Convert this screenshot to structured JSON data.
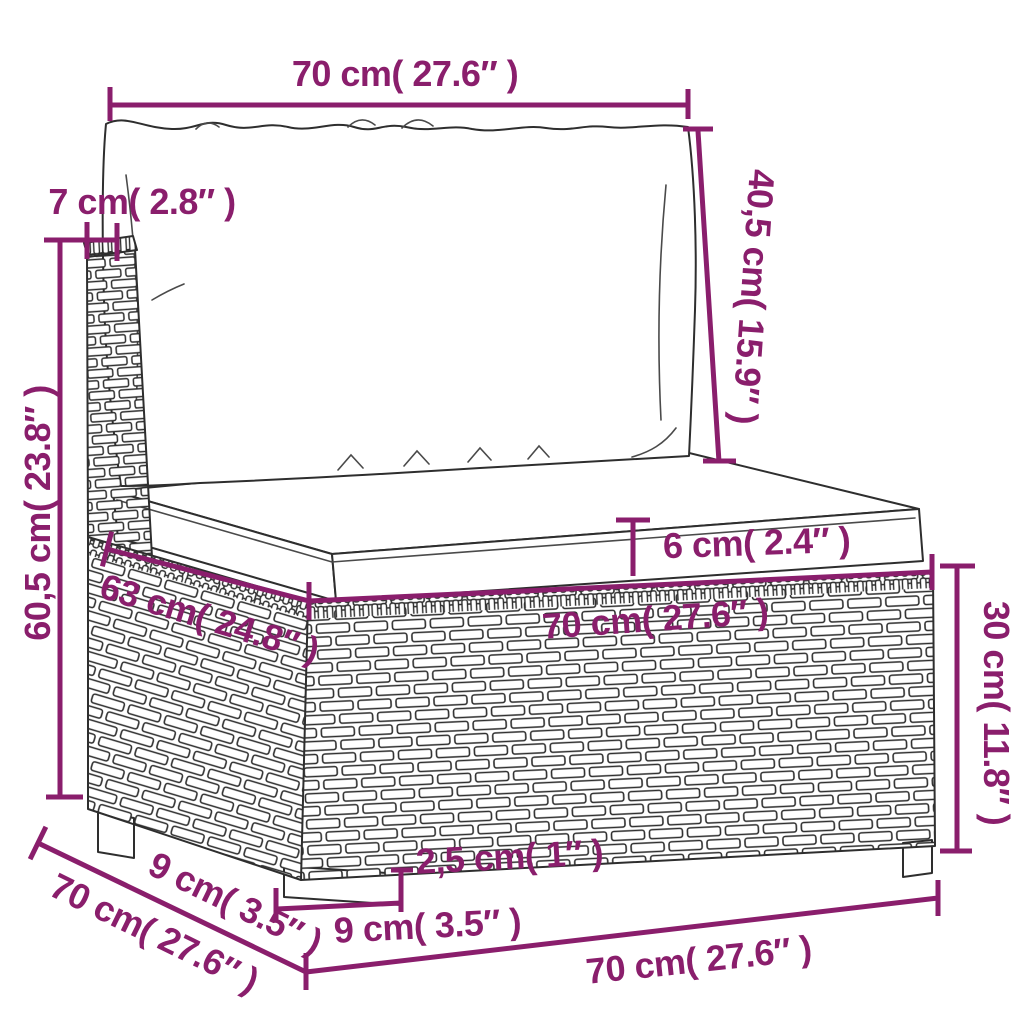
{
  "labels": {
    "width_top": "70 cm( 27.6″ )",
    "back_height": "40,5 cm( 15.9″ )",
    "back_thickness": "7 cm( 2.8″ )",
    "total_height": "60,5 cm( 23.8″ )",
    "cushion_thickness": "6 cm( 2.4″ )",
    "seat_depth": "63 cm( 24.8″ )",
    "seat_width": "70 cm( 27.6″ )",
    "base_height": "30 cm( 11.8″ )",
    "depth_side": "70 cm( 27.6″ )",
    "leg_offset_side": "9 cm( 3.5″ )",
    "leg_height": "2,5 cm( 1″ )",
    "leg_offset_front": "9 cm( 3.5″ )",
    "width_bottom": "70 cm( 27.6″ )"
  },
  "colors": {
    "dimension": "#8a1e6c",
    "line": "#2e2e2e",
    "background": "#ffffff"
  }
}
